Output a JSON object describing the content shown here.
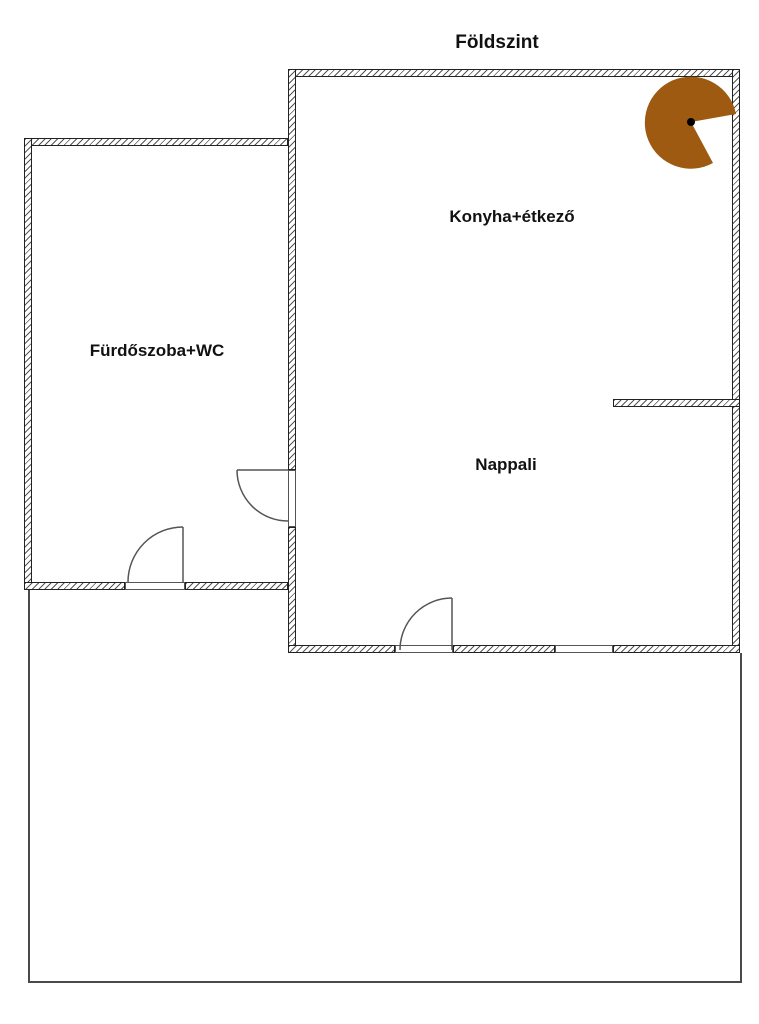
{
  "title": "Földszint",
  "rooms": {
    "kitchen": {
      "label": "Konyha+étkező"
    },
    "bathroom": {
      "label": "Fürdőszoba+WC"
    },
    "living": {
      "label": "Nappali"
    }
  },
  "symbols": {
    "spiral_staircase": {
      "name": "spiral-staircase",
      "fill": "#9d5a10",
      "dot_color": "#000000"
    }
  },
  "colors": {
    "wall_outline": "#222222",
    "hatch_line": "#555555",
    "thin_line": "#4a4a4a",
    "background": "#ffffff"
  }
}
